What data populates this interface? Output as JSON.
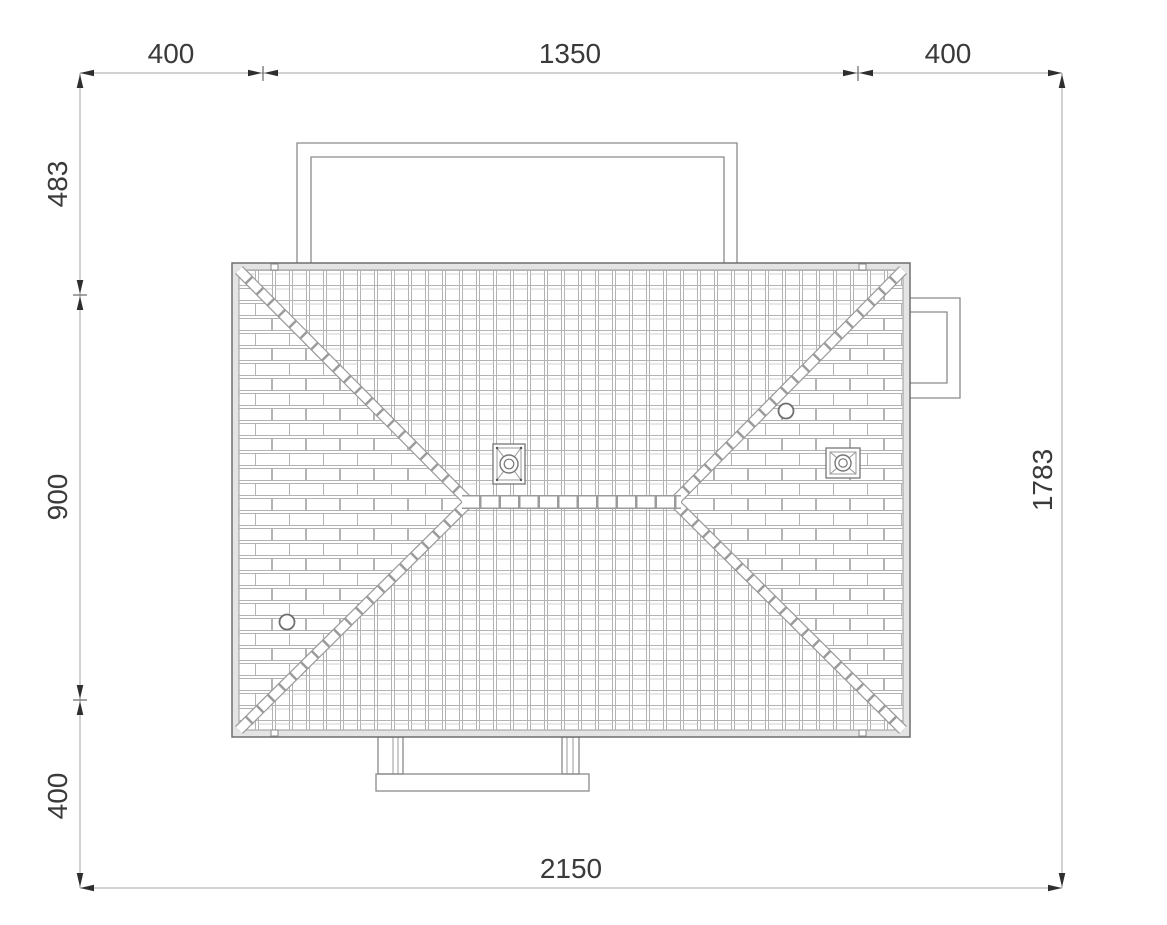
{
  "page": {
    "background": "#ffffff",
    "kind": "architectural roof plan drawing"
  },
  "drawing": {
    "outline_color": "#8a8a8a",
    "roof_edge_color": "#6f6f6f",
    "tile_line_color": "#b3b3b3",
    "dimension_line_color": "#a6a6a6",
    "arrow_color": "#2e2e2e",
    "text_color": "#3a3a3a",
    "features": [
      "hip-roof-tiled",
      "ridge",
      "chimney-left",
      "chimney-right",
      "roof-vent-left",
      "roof-vent-right",
      "upper-terrace-outline",
      "side-bay-outline",
      "entrance-porch-outline"
    ]
  },
  "dimensions": {
    "top": {
      "left": "400",
      "middle": "1350",
      "right": "400"
    },
    "left_side": {
      "top": "483",
      "middle": "900",
      "bottom": "400"
    },
    "right_side": {
      "total": "1783"
    },
    "bottom": {
      "total": "2150"
    }
  }
}
